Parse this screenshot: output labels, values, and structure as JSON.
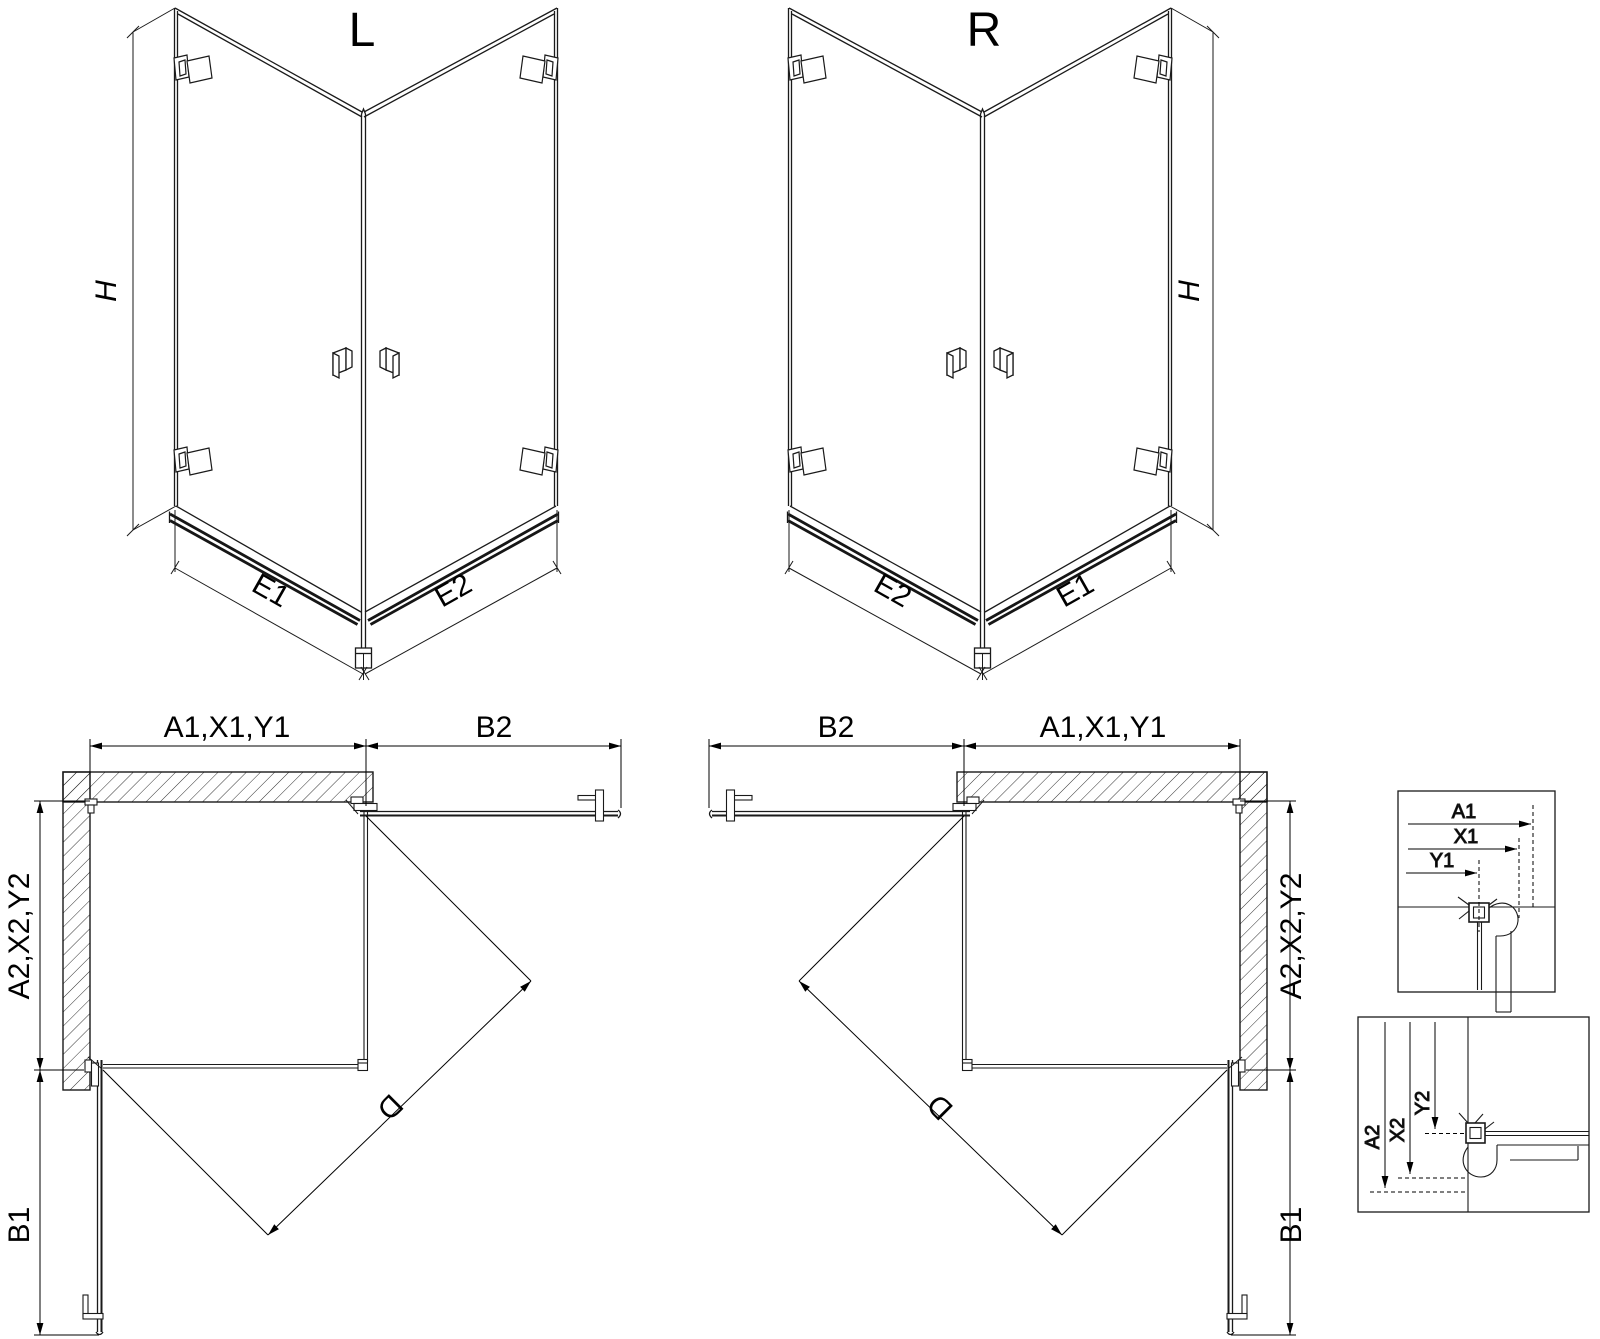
{
  "iso_left": {
    "label": "L",
    "dim_height": "H",
    "dim_bottom_left": "E1",
    "dim_bottom_right": "E2"
  },
  "iso_right": {
    "label": "R",
    "dim_height": "H",
    "dim_bottom_left": "E2",
    "dim_bottom_right": "E1"
  },
  "plan_left": {
    "dim_top": "A1,X1,Y1",
    "dim_top_right": "B2",
    "dim_side": "A2,X2,Y2",
    "dim_side_bottom": "B1",
    "dim_diagonal": "D"
  },
  "plan_right": {
    "dim_top_left": "B2",
    "dim_top": "A1,X1,Y1",
    "dim_side": "A2,X2,Y2",
    "dim_side_bottom": "B1",
    "dim_diagonal": "D"
  },
  "detail_top": {
    "dim_a": "A1",
    "dim_x": "X1",
    "dim_y": "Y1"
  },
  "detail_bottom": {
    "dim_a": "A2",
    "dim_x": "X2",
    "dim_y": "Y2"
  },
  "colors": {
    "line": "#1a1a1a",
    "rail": "#161616",
    "background": "#ffffff"
  }
}
